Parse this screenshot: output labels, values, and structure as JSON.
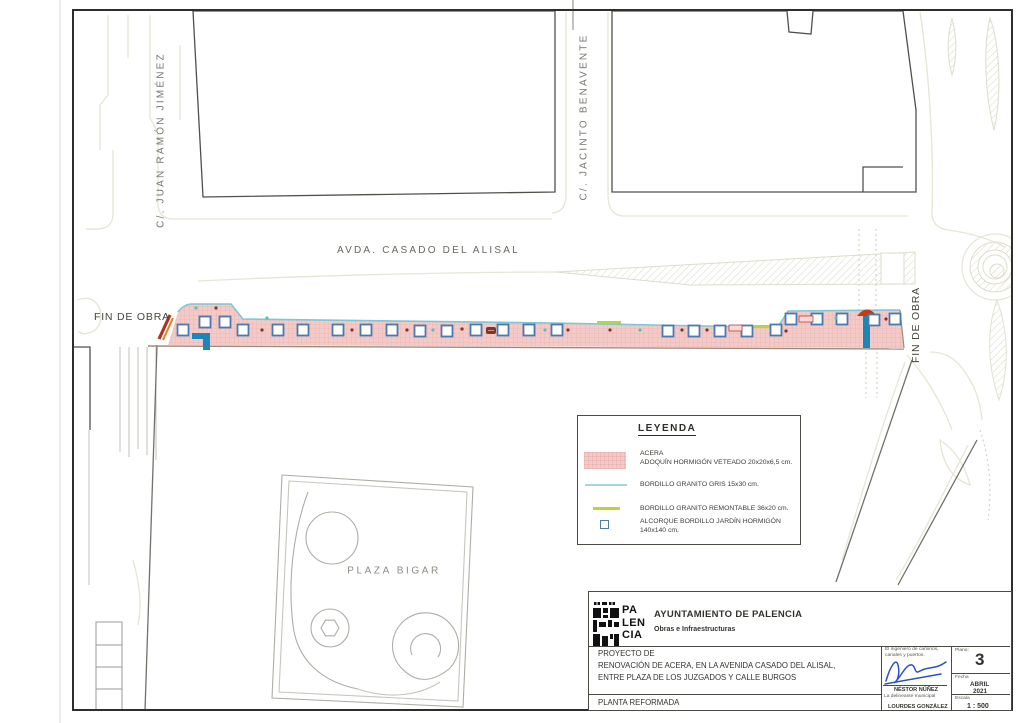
{
  "plan": {
    "streets": {
      "juan_ramon": "C/. JUAN RAMÓN JIMÉNEZ",
      "jacinto": "C/. JACINTO BENAVENTE",
      "avenida": "AVDA. CASADO DEL ALISAL",
      "plaza": "PLAZA BIGAR",
      "fin_obra_left": "FIN DE OBRA",
      "fin_obra_right": "FIN DE OBRA"
    },
    "legend": {
      "title": "LEYENDA",
      "items": [
        {
          "name": "ACERA",
          "spec": "ADOQUÍN HORMIGÓN VETEADO 20x20x6,5 cm."
        },
        {
          "name": "BORDILLO GRANITO GRIS 15x30 cm."
        },
        {
          "name": "BORDILLO GRANITO REMONTABLE 36x20 cm."
        },
        {
          "name": "ALCORQUE BORDILLO JARDÍN HORMIGÓN",
          "spec": "140x140 cm."
        }
      ]
    },
    "title_block": {
      "logo_line1": "PA",
      "logo_line2": "LEN",
      "logo_line3": "CIA",
      "org": "AYUNTAMIENTO DE PALENCIA",
      "dept": "Obras e Infraestructuras",
      "project_label": "PROYECTO DE",
      "project_line1": "RENOVACIÓN DE ACERA, EN LA AVENIDA CASADO DEL ALISAL,",
      "project_line2": "ENTRE PLAZA DE LOS JUZGADOS Y CALLE BURGOS",
      "sheet_name": "PLANTA REFORMADA",
      "engineer_title1": "El ingeniero de caminos,",
      "engineer_title2": "canales y puertos.",
      "engineer_name": "NÉSTOR NÚÑEZ",
      "draftsman_title": "La delineante municipal",
      "draftsman_name": "LOURDES GONZÁLEZ",
      "plano_label": "Plano:",
      "plano_number": "3",
      "fecha_label": "Fecha",
      "fecha_month": "ABRIL",
      "fecha_year": "2021",
      "escala_label": "Escala",
      "escala_value": "1 : 500"
    },
    "colors": {
      "acera_fill": "#f3cac7",
      "bordillo_granito_gris": "#7cc6d6",
      "bordillo_remontable": "#b9d631",
      "alcorque_border": "#4d78b0",
      "signature_blue": "#2b52c4",
      "fin_obra_mark_red": "#b23220",
      "fin_obra_mark_orange": "#e1801e"
    }
  }
}
